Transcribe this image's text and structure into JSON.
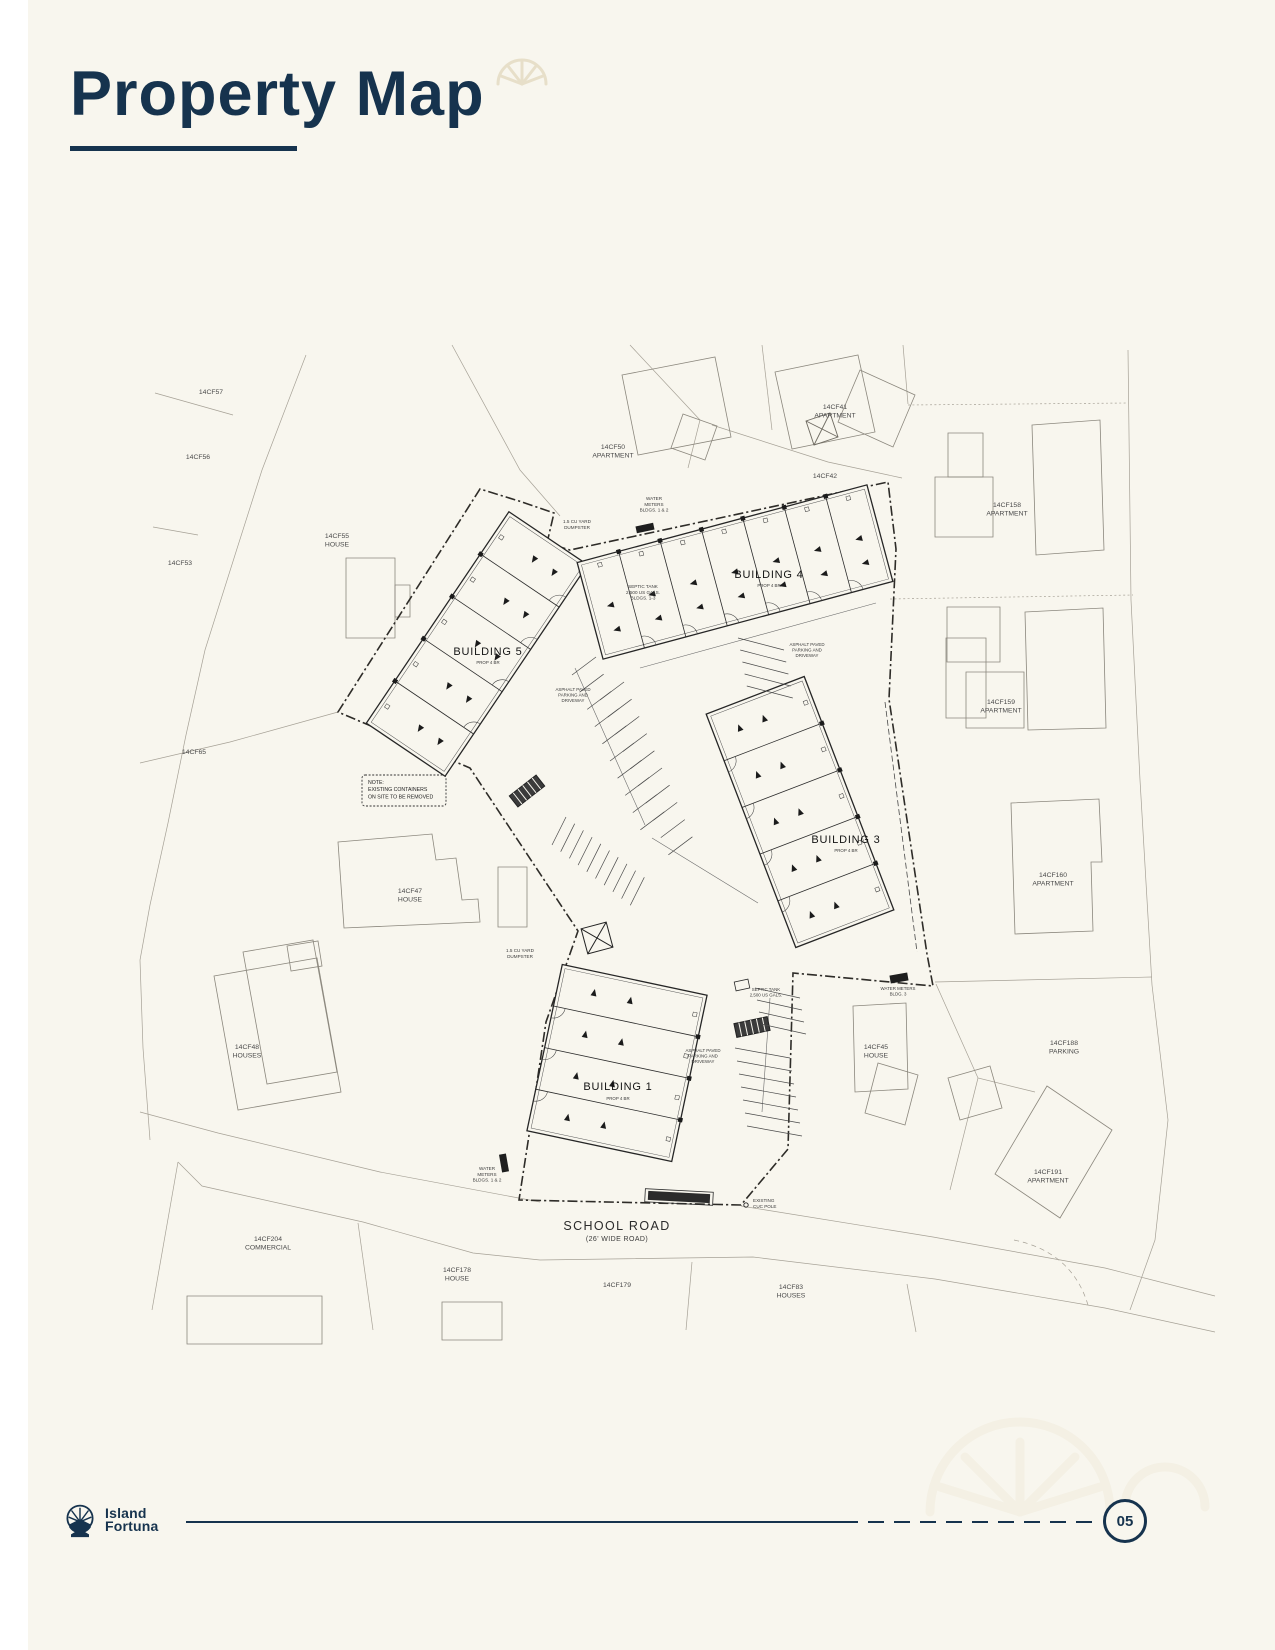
{
  "page": {
    "title": "Property Map",
    "page_number": "05",
    "brand": {
      "line1": "Island",
      "line2": "Fortuna"
    }
  },
  "colors": {
    "navy": "#16334e",
    "background": "#f8f6ee",
    "plan_ink": "#262626",
    "parcel_line": "#a6a196"
  },
  "map": {
    "road_name": "SCHOOL ROAD",
    "road_subtitle": "(26' WIDE ROAD)",
    "note_lines": [
      "NOTE:",
      "EXISTING CONTAINERS",
      "ON SITE TO BE REMOVED"
    ],
    "labels": [
      {
        "n": "parcel-label-14cf57",
        "k": "p",
        "t": [
          "14CF57"
        ],
        "x": 211,
        "y": 394,
        "s": 6.8
      },
      {
        "n": "parcel-label-14cf56",
        "k": "p",
        "t": [
          "14CF56"
        ],
        "x": 198,
        "y": 459,
        "s": 6.8
      },
      {
        "n": "parcel-label-14cf55",
        "k": "p",
        "t": [
          "14CF55",
          "HOUSE"
        ],
        "x": 337,
        "y": 538,
        "s": 6.8
      },
      {
        "n": "parcel-label-14cf53",
        "k": "p",
        "t": [
          "14CF53"
        ],
        "x": 180,
        "y": 565,
        "s": 6.8
      },
      {
        "n": "parcel-label-14cf50",
        "k": "p",
        "t": [
          "14CF50",
          "APARTMENT"
        ],
        "x": 613,
        "y": 449,
        "s": 6.8
      },
      {
        "n": "parcel-label-14cf41",
        "k": "p",
        "t": [
          "14CF41",
          "APARTMENT"
        ],
        "x": 835,
        "y": 409,
        "s": 6.8
      },
      {
        "n": "parcel-label-14cf42",
        "k": "p",
        "t": [
          "14CF42"
        ],
        "x": 825,
        "y": 478,
        "s": 6.8
      },
      {
        "n": "parcel-label-14cf158",
        "k": "p",
        "t": [
          "14CF158",
          "APARTMENT"
        ],
        "x": 1007,
        "y": 507,
        "s": 6.8
      },
      {
        "n": "parcel-label-14cf159",
        "k": "p",
        "t": [
          "14CF159",
          "APARTMENT"
        ],
        "x": 1001,
        "y": 704,
        "s": 6.8
      },
      {
        "n": "parcel-label-14cf160",
        "k": "p",
        "t": [
          "14CF160",
          "APARTMENT"
        ],
        "x": 1053,
        "y": 877,
        "s": 6.8
      },
      {
        "n": "parcel-label-14cf65",
        "k": "p",
        "t": [
          "14CF65"
        ],
        "x": 194,
        "y": 754,
        "s": 6.8
      },
      {
        "n": "parcel-label-14cf47",
        "k": "p",
        "t": [
          "14CF47",
          "HOUSE"
        ],
        "x": 410,
        "y": 893,
        "s": 6.8
      },
      {
        "n": "parcel-label-14cf48",
        "k": "p",
        "t": [
          "14CF48",
          "HOUSES"
        ],
        "x": 247,
        "y": 1049,
        "s": 6.8
      },
      {
        "n": "parcel-label-14cf45",
        "k": "p",
        "t": [
          "14CF45",
          "HOUSE"
        ],
        "x": 876,
        "y": 1049,
        "s": 6.8
      },
      {
        "n": "parcel-label-14cf188",
        "k": "p",
        "t": [
          "14CF188",
          "PARKING"
        ],
        "x": 1064,
        "y": 1045,
        "s": 6.8
      },
      {
        "n": "parcel-label-14cf191",
        "k": "p",
        "t": [
          "14CF191",
          "APARTMENT"
        ],
        "x": 1048,
        "y": 1174,
        "s": 6.8
      },
      {
        "n": "parcel-label-14cf204",
        "k": "p",
        "t": [
          "14CF204",
          "COMMERCIAL"
        ],
        "x": 268,
        "y": 1241,
        "s": 6.8
      },
      {
        "n": "parcel-label-14cf178",
        "k": "p",
        "t": [
          "14CF178",
          "HOUSE"
        ],
        "x": 457,
        "y": 1272,
        "s": 6.8
      },
      {
        "n": "parcel-label-14cf179",
        "k": "p",
        "t": [
          "14CF179"
        ],
        "x": 617,
        "y": 1287,
        "s": 6.8
      },
      {
        "n": "parcel-label-14cf83",
        "k": "p",
        "t": [
          "14CF83",
          "HOUSES"
        ],
        "x": 791,
        "y": 1289,
        "s": 6.8
      },
      {
        "n": "annotation-water-meters-top",
        "k": "a",
        "t": [
          "WATER",
          "METERS",
          "BLDGS. 1 & 2"
        ],
        "x": 654,
        "y": 500,
        "s": 4.6
      },
      {
        "n": "annotation-dumpster-top",
        "k": "a",
        "t": [
          "1.5 CU YARD",
          "DUMPSTER"
        ],
        "x": 577,
        "y": 523,
        "s": 4.6
      },
      {
        "n": "annotation-septic-tank-top",
        "k": "a",
        "t": [
          "SEPTIC TANK",
          "2,500 US GALS.",
          "BLDGS. 1-3"
        ],
        "x": 643,
        "y": 588,
        "s": 4.6
      },
      {
        "n": "annotation-asphalt-west",
        "k": "a",
        "t": [
          "ASPHALT PAVED",
          "PARKING AND",
          "DRIVEWAY"
        ],
        "x": 573,
        "y": 691,
        "s": 4.4
      },
      {
        "n": "annotation-asphalt-east",
        "k": "a",
        "t": [
          "ASPHALT PAVED",
          "PARKING AND",
          "DRIVEWAY"
        ],
        "x": 807,
        "y": 646,
        "s": 4.4
      },
      {
        "n": "annotation-asphalt-south",
        "k": "a",
        "t": [
          "ASPHALT PAVED",
          "PARKING AND",
          "DRIVEWAY"
        ],
        "x": 703,
        "y": 1052,
        "s": 4.4
      },
      {
        "n": "annotation-dumpster-mid",
        "k": "a",
        "t": [
          "1.5 CU YARD",
          "DUMPSTER"
        ],
        "x": 520,
        "y": 952,
        "s": 4.6
      },
      {
        "n": "annotation-septic-tank-south",
        "k": "a",
        "t": [
          "SEPTIC TANK",
          "2,500 US GALS."
        ],
        "x": 766,
        "y": 991,
        "s": 4.4
      },
      {
        "n": "annotation-water-meters-bottom",
        "k": "a",
        "t": [
          "WATER",
          "METERS",
          "BLDGS. 1 & 2"
        ],
        "x": 487,
        "y": 1170,
        "s": 4.6
      },
      {
        "n": "annotation-water-meters-bldg3",
        "k": "a",
        "t": [
          "WATER METERS",
          "BLDG. 3"
        ],
        "x": 898,
        "y": 990,
        "s": 4.4
      },
      {
        "n": "annotation-existing-cuc-pole",
        "k": "a",
        "t": [
          "EXISTING",
          "CUC POLE"
        ],
        "x": 753,
        "y": 1202,
        "s": 4.6,
        "a": "s"
      },
      {
        "n": "note-text",
        "k": "n",
        "t": [
          "NOTE:",
          "EXISTING CONTAINERS",
          "ON SITE TO BE REMOVED"
        ],
        "x": 368,
        "y": 784,
        "s": 5.2,
        "lh": 7.2,
        "a": "s"
      },
      {
        "n": "building-label-5",
        "k": "b",
        "t": [
          "BUILDING 5"
        ],
        "x": 488,
        "y": 655,
        "s": 11
      },
      {
        "n": "building-sub-5",
        "k": "s",
        "t": [
          "PROP 4 BR"
        ],
        "x": 488,
        "y": 664,
        "s": 4.4
      },
      {
        "n": "building-label-4",
        "k": "b",
        "t": [
          "BUILDING 4"
        ],
        "x": 769,
        "y": 578,
        "s": 11
      },
      {
        "n": "building-sub-4",
        "k": "s",
        "t": [
          "PROP 4 BR"
        ],
        "x": 769,
        "y": 587,
        "s": 4.4
      },
      {
        "n": "building-label-3",
        "k": "b",
        "t": [
          "BUILDING 3"
        ],
        "x": 846,
        "y": 843,
        "s": 11
      },
      {
        "n": "building-sub-3",
        "k": "s",
        "t": [
          "PROP 4 BR"
        ],
        "x": 846,
        "y": 852,
        "s": 4.4
      },
      {
        "n": "building-label-1",
        "k": "b",
        "t": [
          "BUILDING 1"
        ],
        "x": 618,
        "y": 1090,
        "s": 11
      },
      {
        "n": "building-sub-1",
        "k": "s",
        "t": [
          "PROP 4 BR"
        ],
        "x": 618,
        "y": 1100,
        "s": 4.4
      },
      {
        "n": "road-name",
        "k": "r",
        "t": [
          "SCHOOL ROAD"
        ],
        "x": 617,
        "y": 1230,
        "s": 12.5
      },
      {
        "n": "road-subtitle",
        "k": "r2",
        "t": [
          "(26' WIDE ROAD)"
        ],
        "x": 617,
        "y": 1241,
        "s": 7
      }
    ]
  }
}
